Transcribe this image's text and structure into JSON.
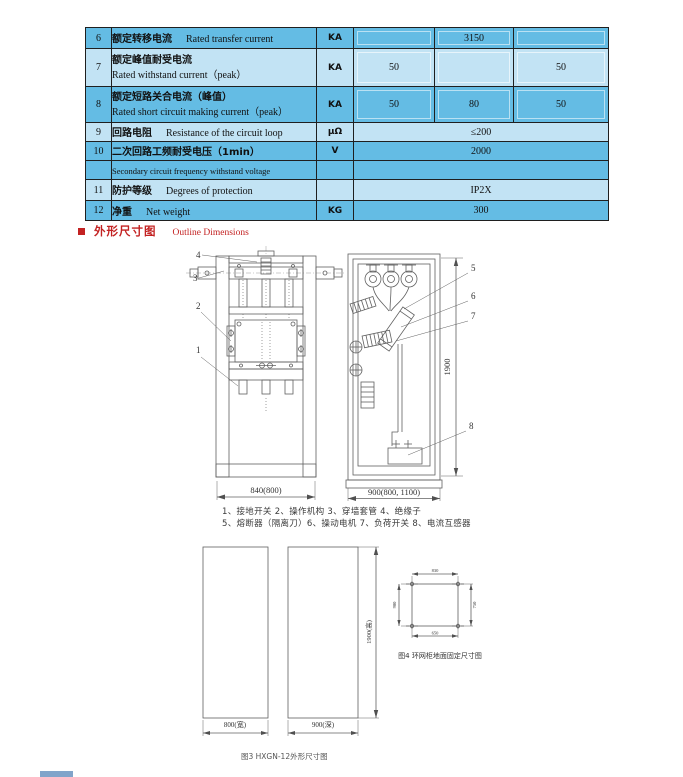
{
  "table": {
    "rows": [
      {
        "no": "6",
        "zh": "额定转移电流",
        "en": "Rated transfer current",
        "unit": "KA",
        "v1": "",
        "v2": "3150",
        "v3": ""
      },
      {
        "no": "7",
        "zh": "额定峰值耐受电流",
        "en": "Rated withstand current（peak）",
        "unit": "KA",
        "v1": "50",
        "v2": "",
        "v3": "50"
      },
      {
        "no": "8",
        "zh": "额定短路关合电流（峰值）",
        "en": "Rated short circuit making current（peak）",
        "unit": "KA",
        "v1": "50",
        "v2": "80",
        "v3": "50"
      },
      {
        "no": "9",
        "zh": "回路电阻",
        "en": "Resistance of the circuit loop",
        "unit": "μΩ",
        "value": "≤200"
      },
      {
        "no": "10",
        "zh": "二次回路工频耐受电压（1min）",
        "en": "Secondary circuit frequency withstand voltage",
        "unit": "V",
        "value": "2000"
      },
      {
        "no": "11",
        "zh": "防护等级",
        "en": "Degrees of protection",
        "unit": "",
        "value": "IP2X"
      },
      {
        "no": "12",
        "zh": "净重",
        "en": "Net weight",
        "unit": "KG",
        "value": "300"
      }
    ]
  },
  "section": {
    "title_zh": "外形尺寸图",
    "title_en": "Outline Dimensions"
  },
  "front_view": {
    "dim_width": "840(800)",
    "callout_1": "1",
    "callout_2": "2",
    "callout_3": "3",
    "callout_4": "4"
  },
  "side_view": {
    "dim_width": "900(800, 1100)",
    "dim_height": "1900",
    "callout_5": "5",
    "callout_6": "6",
    "callout_7": "7",
    "callout_8": "8"
  },
  "legend": {
    "line1": "1、接地开关 2、操作机构 3、穿墙套管 4、绝缘子",
    "line2": "5、熔断器（隔离刀）6、操动电机 7、负荷开关 8、电流互感器"
  },
  "outline": {
    "width_dim": "800(宽)",
    "depth_dim": "900(深)",
    "height_dim": "1900(高)"
  },
  "fixing": {
    "dim_top": "830",
    "dim_left": "900",
    "dim_right": "750",
    "dim_bottom": "650",
    "caption": "图4 环网柜地面固定尺寸图"
  },
  "captions": {
    "fig3": "图3 HXGN-12外形尺寸图"
  },
  "colors": {
    "row_dark": "#64bce4",
    "row_light": "#c2e3f4",
    "accent_red": "#c32222",
    "drawing_line": "#606060"
  }
}
